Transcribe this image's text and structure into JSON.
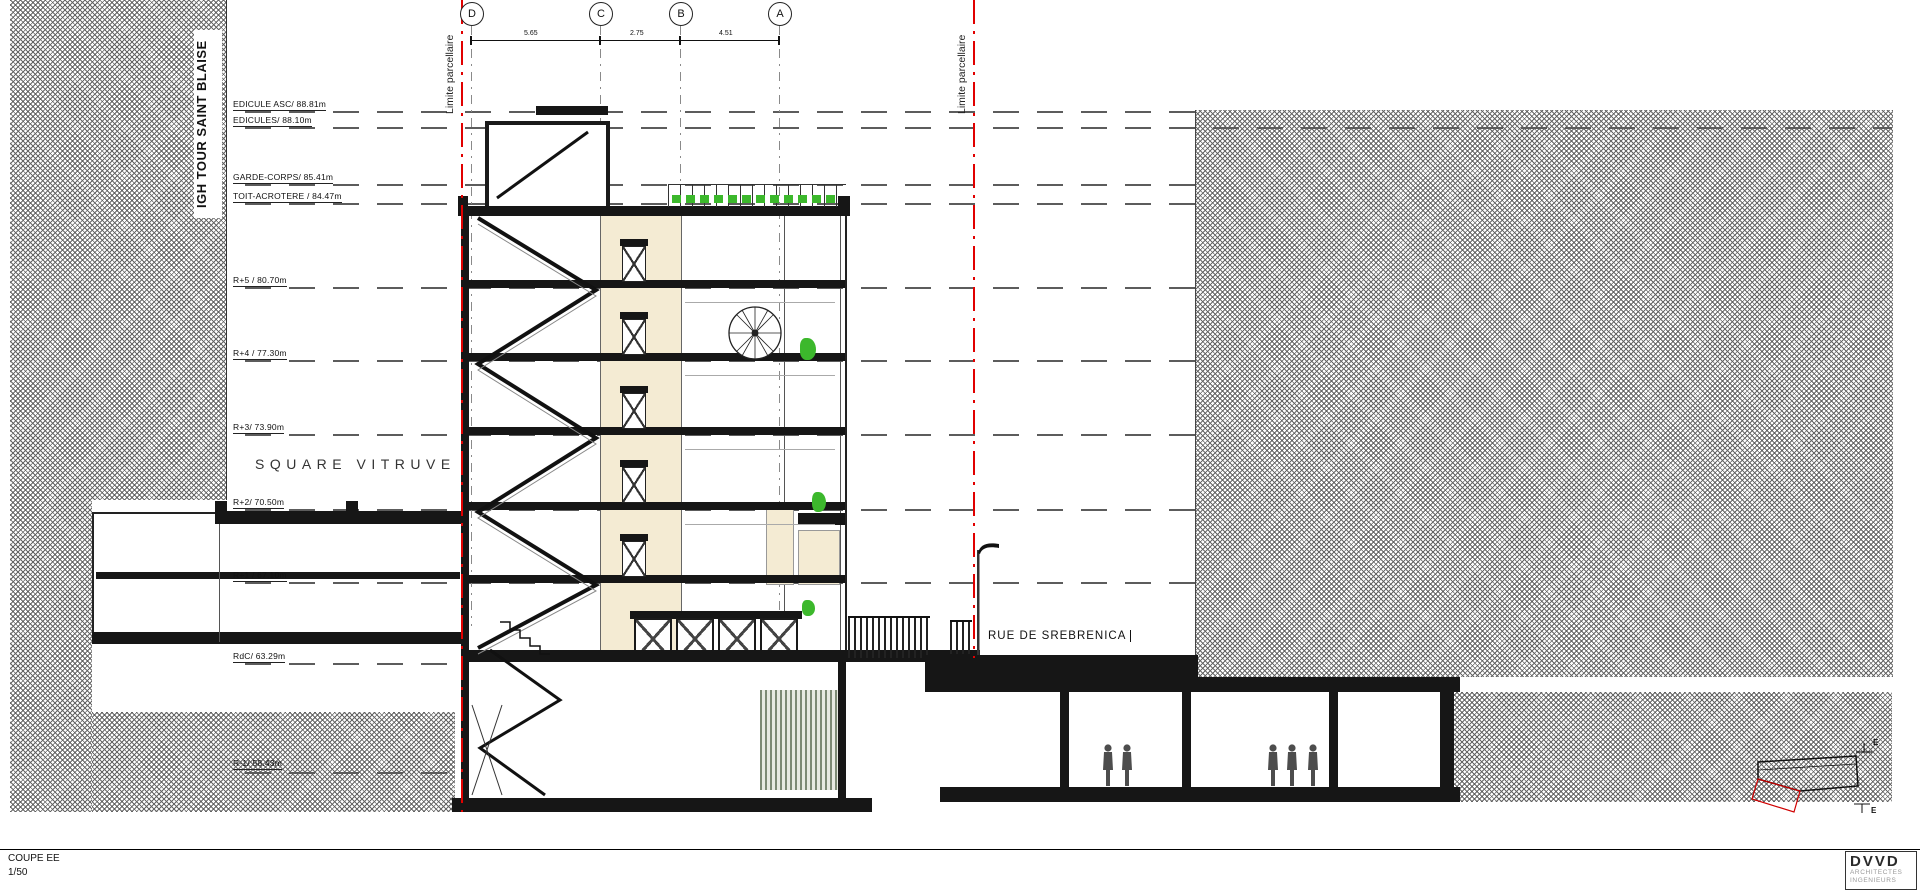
{
  "titleblock": {
    "title": "COUPE EE",
    "scale": "1/50"
  },
  "logo": {
    "name": "DVVD",
    "line1": "ARCHITECTES",
    "line2": "INGENIEURS"
  },
  "annotations": {
    "site_left": "IGH TOUR SAINT BLAISE",
    "square": "SQUARE VITRUVE",
    "street": "RUE DE SREBRENICA",
    "limit_left": "Limite parcellaire",
    "limit_right": "Limite parcellaire"
  },
  "levels": [
    {
      "label": "EDICULE ASC/ 88.81m"
    },
    {
      "label": "EDICULES/ 88.10m"
    },
    {
      "label": "GARDE-CORPS/ 85.41m"
    },
    {
      "label": "TOIT-ACROTERE / 84.47m"
    },
    {
      "label": "R+5 / 80.70m"
    },
    {
      "label": "R+4 / 77.30m"
    },
    {
      "label": "R+3/ 73.90m"
    },
    {
      "label": "R+2/ 70.50m"
    },
    {
      "label": "R+1 / 67.10m"
    },
    {
      "label": "RdC/ 63.29m"
    },
    {
      "label": "R-1/ 58.43m"
    }
  ],
  "grid": {
    "bubbles": [
      "D",
      "C",
      "B",
      "A"
    ],
    "dims": [
      "5.65",
      "2.75",
      "4.51"
    ]
  },
  "section_markers": {
    "letter": "E"
  },
  "colors": {
    "parcel_line": "#e10000",
    "vegetation": "#3cb82c",
    "wall_fill": "#f4ebd3",
    "hatch_gray": "#5f5f5f"
  }
}
